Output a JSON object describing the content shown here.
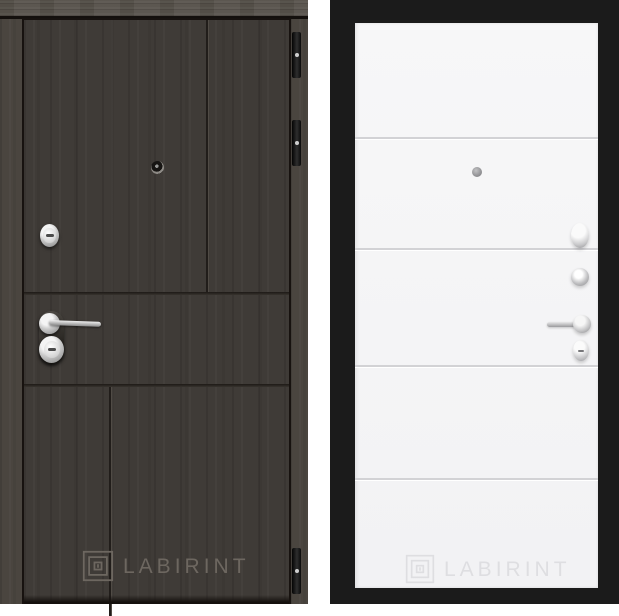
{
  "product_gallery": {
    "left_door": {
      "logo": {
        "icon": "labyrinth-logo-icon",
        "text": "LABIRINT",
        "text_color": "#6d6760"
      },
      "colors": {
        "leaf": "#3f3b37",
        "frame": "#4a453f",
        "header_rail": "#57524b",
        "outline": "#17120f",
        "hardware": "#c9c9c9"
      },
      "hardware": {
        "peephole": "peephole-icon",
        "upper_lock": "round-cylinder-lock",
        "handle": "lever-handle-pointing-right",
        "lower_lock": "round-key-cylinder",
        "hinge_count": 3
      }
    },
    "right_door": {
      "logo": {
        "icon": "labyrinth-logo-icon",
        "text": "LABIRINT",
        "text_color": "#dedee1"
      },
      "colors": {
        "leaf": "#f5f5f6",
        "backdrop": "#1b1b1b",
        "groove": "#d2d2d5",
        "hardware": "#c7c7c9"
      },
      "hardware": {
        "peephole": "peephole-icon",
        "night_latch": "oval-thumbturn",
        "turn_knob": "round-thumbturn",
        "handle": "lever-handle-pointing-left",
        "lower_lock": "oval-key-cylinder"
      },
      "groove_count": 4
    }
  }
}
